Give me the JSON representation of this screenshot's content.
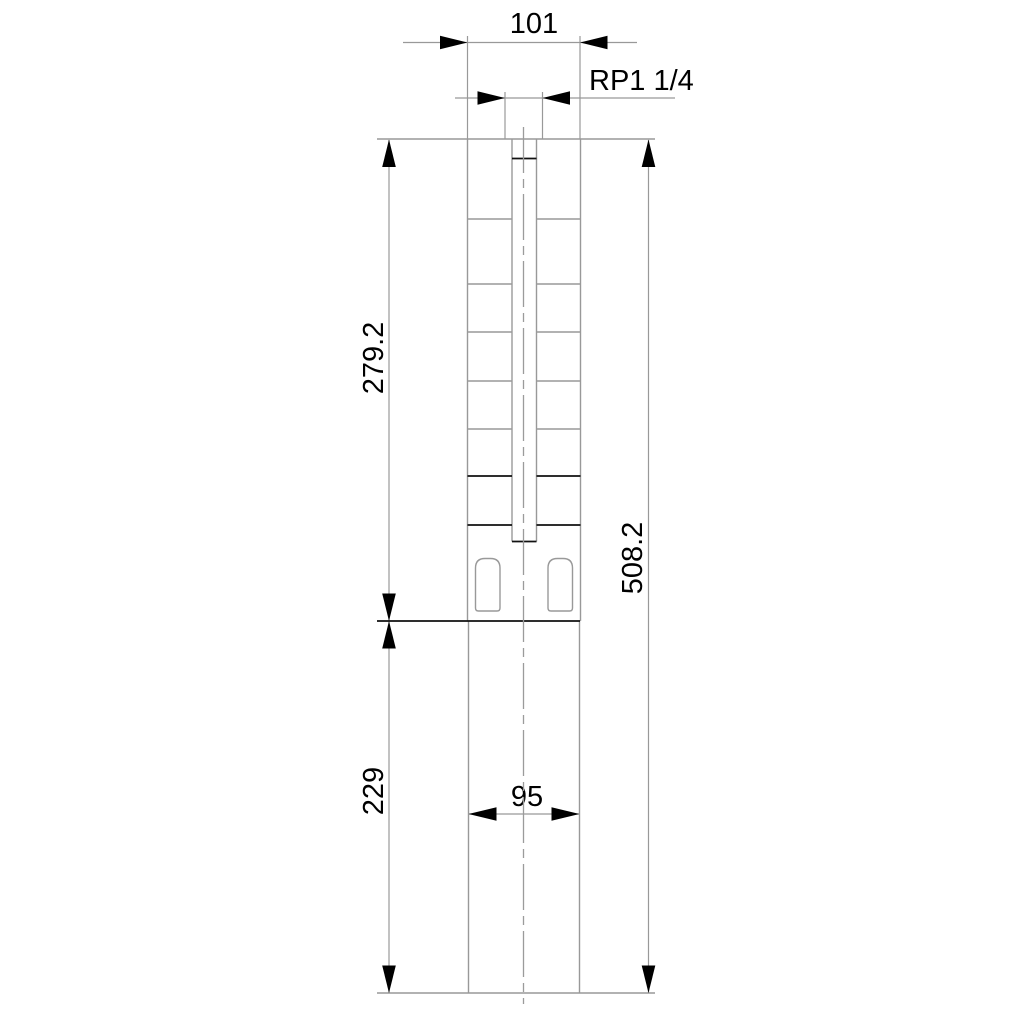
{
  "drawing": {
    "dimensions": [
      {
        "id": "top-width",
        "label": "101"
      },
      {
        "id": "discharge-thread",
        "label": "RP1 1/4"
      },
      {
        "id": "pump-end-length",
        "label": "279.2"
      },
      {
        "id": "overall-length",
        "label": "508.2"
      },
      {
        "id": "motor-length",
        "label": "229"
      },
      {
        "id": "motor-width",
        "label": "95"
      }
    ],
    "colors": {
      "outline_gray": "#999999",
      "detail_black": "#000000",
      "background": "#ffffff"
    }
  }
}
